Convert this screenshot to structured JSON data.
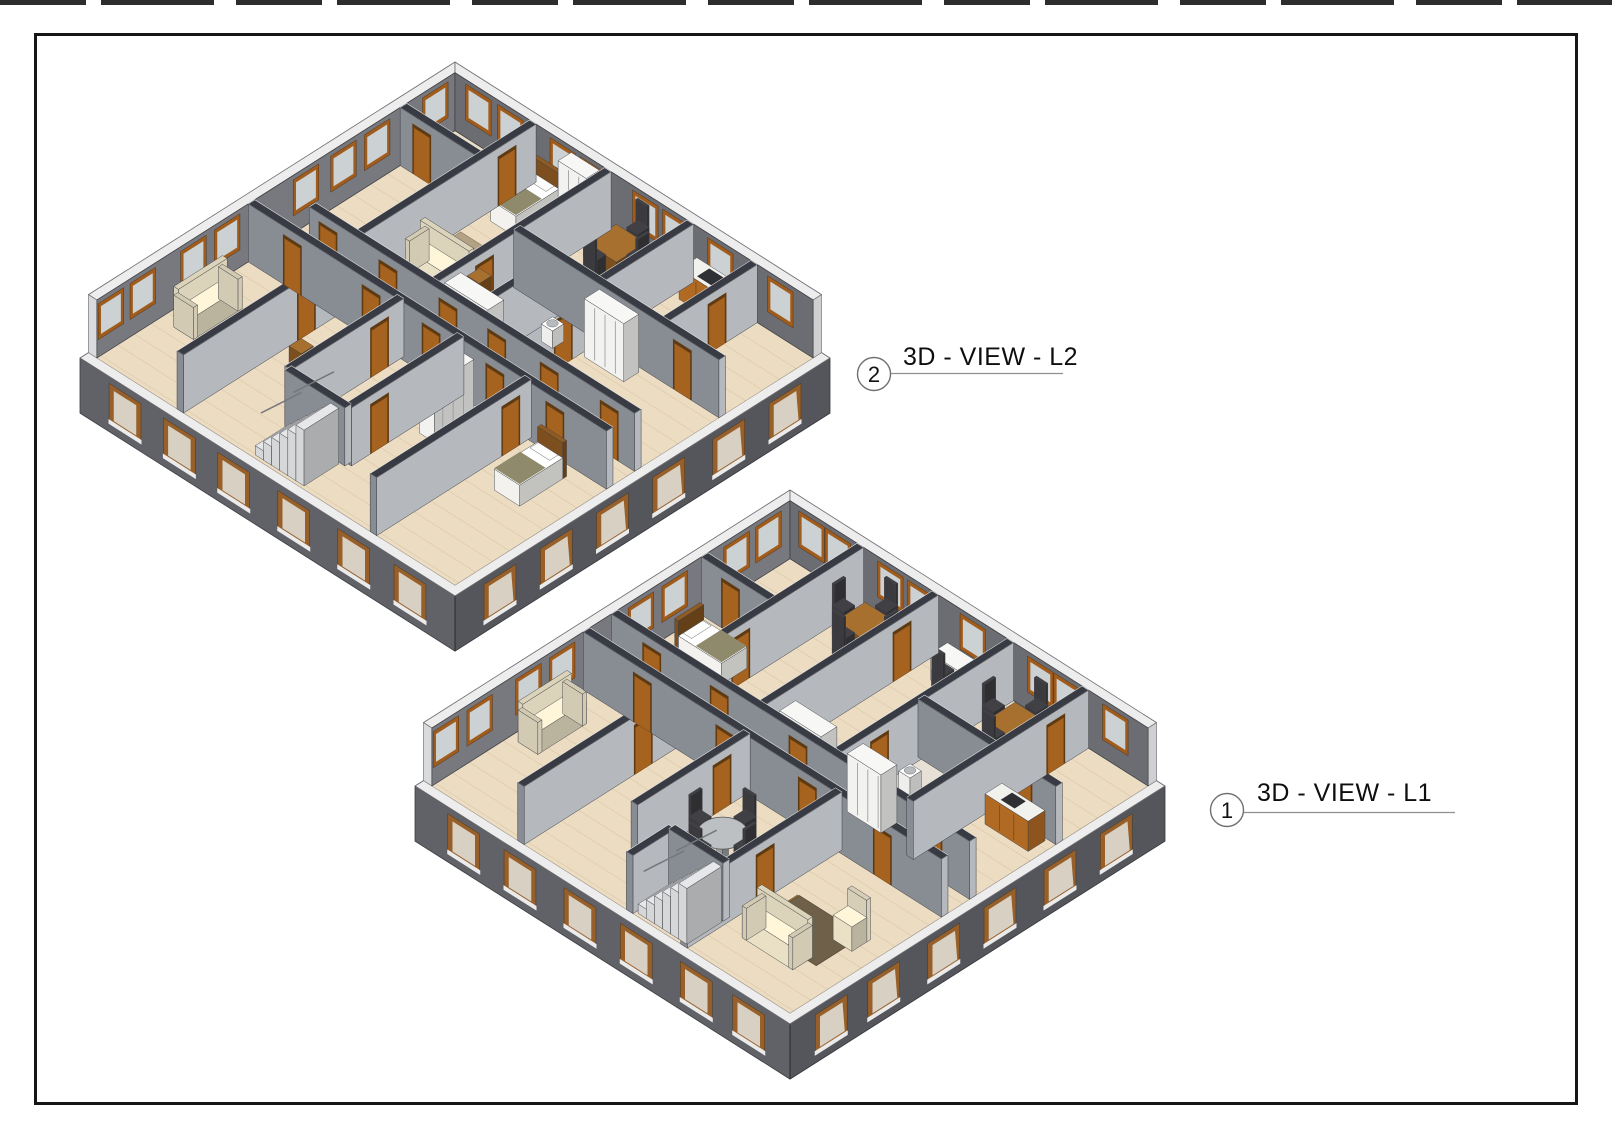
{
  "sheet": {
    "background": "#ffffff",
    "border_color": "#161616",
    "top_crop_marks": "cropped text row"
  },
  "palette": {
    "ext_sw": "#606267",
    "ext_se": "#54565b",
    "band": "#ededee",
    "floor": "#ecdcc2",
    "plank_line": "rgba(150,120,80,0.18)",
    "tile": "#e6e0d6",
    "far_left": "#77797e",
    "far_right": "#6b6d72",
    "face_l": "#b5b8bd",
    "face_m": "#888c93",
    "cap": "#383b43",
    "cap_edge": "#e8e8e8",
    "win_frame": "#a05c1d",
    "win_glass": "#ccd1d4",
    "near_win_frame": "#97602b",
    "near_win_glass": "#d8d1c3",
    "near_win_sill": "#ebebeb",
    "door": "#a6631f",
    "door_frame": "#5e3a12",
    "wood": "#7d4f1e",
    "wood_top": "#a8702f",
    "white": "#f3f2ef",
    "cream": "#e9e0c6",
    "chair": "#3b3b3f",
    "blanket": "#8f8a6b",
    "stair": "#d6d7d8",
    "railing": "#75777c",
    "outline": "#3f4146",
    "callout_line": "#8f8f8f",
    "callout_circle": "#707070"
  },
  "views": [
    {
      "id": "view-l2",
      "callout": {
        "number": "2",
        "title": "3D - VIEW - L2"
      },
      "building": {
        "origin": {
          "x": 455,
          "y": 120
        },
        "iso": {
          "A": 18.75,
          "B": 11.9,
          "H": 58
        },
        "plan": 20,
        "band": 0.45,
        "slab": 0.95,
        "walls": [
          {
            "o": "x",
            "c": 9.8,
            "a": 2.2,
            "b": 19.55,
            "doors": [
              3.2,
              6.4,
              9.6,
              12.2,
              15.0,
              18.2
            ]
          },
          {
            "o": "x",
            "c": 11.3,
            "a": 0.45,
            "b": 19.55,
            "doors": [
              2.8,
              7.0,
              10.2,
              13.6,
              16.8
            ]
          },
          {
            "o": "y",
            "c": 4.6,
            "a": 0.45,
            "b": 9.8,
            "doors": [
              2.0
            ]
          },
          {
            "o": "y",
            "c": 8.6,
            "a": 0.45,
            "b": 9.8,
            "doors": [
              7.2
            ]
          },
          {
            "o": "x",
            "c": 5.3,
            "a": 8.6,
            "b": 19.55,
            "doors": [
              14.2,
              17.6
            ]
          },
          {
            "o": "y",
            "c": 13.0,
            "a": 0.45,
            "b": 9.8,
            "doors": [
              7.4
            ]
          },
          {
            "o": "y",
            "c": 16.4,
            "a": 0.45,
            "b": 5.3,
            "doors": [
              2.6
            ]
          },
          {
            "o": "y",
            "c": 10.8,
            "a": 5.3,
            "b": 9.8,
            "doors": []
          },
          {
            "o": "x",
            "c": 3.2,
            "a": 0.45,
            "b": 4.6,
            "doors": [
              1.6
            ]
          },
          {
            "o": "y",
            "c": 4.9,
            "a": 11.3,
            "b": 19.55,
            "doors": [
              13.0
            ]
          },
          {
            "o": "y",
            "c": 8.4,
            "a": 11.3,
            "b": 17.3,
            "doors": [
              12.6
            ]
          },
          {
            "o": "y",
            "c": 11.6,
            "a": 11.3,
            "b": 17.3,
            "doors": [
              15.8
            ]
          },
          {
            "o": "x",
            "c": 17.3,
            "a": 8.4,
            "b": 11.6,
            "doors": []
          },
          {
            "o": "y",
            "c": 15.2,
            "a": 11.3,
            "b": 19.55,
            "doors": [
              12.4
            ]
          }
        ],
        "far_windows": {
          "left": [
            1.5,
            4.6,
            6.4,
            8.4,
            12.6,
            14.4,
            17.1,
            18.8
          ],
          "right": [
            1.7,
            3.4,
            6.2,
            7.8,
            10.6,
            12.2,
            14.6,
            17.8
          ]
        },
        "near_windows": {
          "sw": [
            2.4,
            5.3,
            8.2,
            11.4,
            14.6,
            17.6
          ],
          "se": [
            2.4,
            5.4,
            8.6,
            11.6,
            14.6,
            17.6
          ]
        },
        "floor_patches": [
          {
            "x": 8.8,
            "y": 5.5,
            "w": 4.0,
            "d": 4.1,
            "c": "#e6e0d6"
          }
        ],
        "furniture": [
          {
            "t": "bed",
            "x": 5.2,
            "y": 0.8,
            "w": 1.35,
            "d": 2.5,
            "dir": "y"
          },
          {
            "t": "wardrobe",
            "x": 6.9,
            "y": 0.7,
            "w": 1.5,
            "d": 0.7
          },
          {
            "t": "rug",
            "x": 4.9,
            "y": 4.6,
            "w": 2.9,
            "d": 2.1,
            "c": "#b3a183"
          },
          {
            "t": "sofa",
            "x": 5.0,
            "y": 6.6,
            "w": 2.6,
            "d": 1.05,
            "dir": "x"
          },
          {
            "t": "sidetable",
            "x": 7.9,
            "y": 6.6
          },
          {
            "t": "table4",
            "x": 10.6,
            "y": 2.0
          },
          {
            "t": "counter",
            "x": 13.5,
            "y": 0.6,
            "w": 2.7,
            "d": 0.95
          },
          {
            "t": "wardrobe",
            "x": 9.0,
            "y": 8.7,
            "w": 2.3,
            "d": 0.85
          },
          {
            "t": "wardrobe",
            "x": 13.4,
            "y": 5.7,
            "w": 2.1,
            "d": 0.8
          },
          {
            "t": "sink",
            "x": 9.3,
            "y": 6.2
          },
          {
            "t": "sink",
            "x": 11.6,
            "y": 6.4
          },
          {
            "t": "bed",
            "x": 16.6,
            "y": 12.0,
            "w": 1.35,
            "d": 2.5,
            "dir": "y"
          },
          {
            "t": "sofa",
            "x": 1.2,
            "y": 13.6,
            "w": 1.05,
            "d": 2.6,
            "dir": "y"
          },
          {
            "t": "wardrobe",
            "x": 12.2,
            "y": 12.0,
            "w": 0.8,
            "d": 2.1,
            "dir": "y"
          },
          {
            "t": "sidetable",
            "x": 6.1,
            "y": 14.3
          }
        ],
        "stairs": {
          "x": 8.75,
          "y": 17.55,
          "len": 2.6,
          "wid": 1.85
        }
      }
    },
    {
      "id": "view-l1",
      "callout": {
        "number": "1",
        "title": "3D - VIEW - L1"
      },
      "building": {
        "origin": {
          "x": 790,
          "y": 548
        },
        "iso": {
          "A": 18.75,
          "B": 11.9,
          "H": 58
        },
        "plan": 20,
        "band": 0.45,
        "slab": 0.95,
        "walls": [
          {
            "o": "x",
            "c": 9.8,
            "a": 0.45,
            "b": 19.55,
            "doors": [
              2.6,
              6.2,
              10.4,
              14.0,
              17.6
            ]
          },
          {
            "o": "x",
            "c": 11.3,
            "a": 0.45,
            "b": 19.55,
            "doors": [
              3.6,
              8.0,
              12.4,
              16.4
            ]
          },
          {
            "o": "y",
            "c": 4.2,
            "a": 0.45,
            "b": 9.8,
            "doors": [
              7.0
            ]
          },
          {
            "o": "y",
            "c": 8.2,
            "a": 0.45,
            "b": 9.8,
            "doors": [
              2.4
            ]
          },
          {
            "o": "y",
            "c": 12.2,
            "a": 0.45,
            "b": 9.8,
            "doors": [
              7.6
            ]
          },
          {
            "o": "y",
            "c": 16.2,
            "a": 0.45,
            "b": 9.8,
            "doors": [
              2.2
            ]
          },
          {
            "o": "x",
            "c": 5.2,
            "a": 12.2,
            "b": 19.55,
            "doors": [
              17.8
            ]
          },
          {
            "o": "x",
            "c": 5.0,
            "a": 0.45,
            "b": 4.2,
            "doors": [
              2.0
            ]
          },
          {
            "o": "y",
            "c": 5.2,
            "a": 11.3,
            "b": 19.55,
            "doors": [
              13.2
            ]
          },
          {
            "o": "y",
            "c": 9.0,
            "a": 11.3,
            "b": 17.3,
            "doors": [
              12.8
            ]
          },
          {
            "o": "y",
            "c": 13.9,
            "a": 11.3,
            "b": 19.55,
            "doors": [
              15.4
            ]
          },
          {
            "o": "x",
            "c": 17.3,
            "a": 11.0,
            "b": 13.9,
            "doors": []
          },
          {
            "o": "y",
            "c": 11.0,
            "a": 17.3,
            "b": 19.55,
            "doors": []
          }
        ],
        "far_windows": {
          "left": [
            1.6,
            3.3,
            6.6,
            8.4,
            12.6,
            14.4,
            17.0,
            18.8
          ],
          "right": [
            1.6,
            3.0,
            5.8,
            7.4,
            10.2,
            13.8,
            15.2,
            17.8
          ]
        },
        "near_windows": {
          "sw": [
            2.6,
            5.6,
            8.8,
            11.8,
            15.0,
            17.8
          ],
          "se": [
            2.6,
            5.6,
            8.8,
            11.8,
            15.0,
            17.8
          ]
        },
        "floor_patches": [
          {
            "x": 12.4,
            "y": 5.4,
            "w": 3.6,
            "d": 4.2,
            "c": "#e6e0d6"
          }
        ],
        "furniture": [
          {
            "t": "table4",
            "x": 6.2,
            "y": 2.2
          },
          {
            "t": "table4",
            "x": 14.4,
            "y": 2.4
          },
          {
            "t": "desk",
            "x": 9.3,
            "y": 0.9,
            "w": 2.2,
            "d": 0.9
          },
          {
            "t": "bed",
            "x": 1.4,
            "y": 6.2,
            "w": 2.5,
            "d": 1.35,
            "dir": "x"
          },
          {
            "t": "wardrobe",
            "x": 9.0,
            "y": 8.7,
            "w": 2.2,
            "d": 0.85
          },
          {
            "t": "wardrobe",
            "x": 12.6,
            "y": 8.7,
            "w": 1.8,
            "d": 0.85
          },
          {
            "t": "counter",
            "x": 16.8,
            "y": 5.5,
            "w": 2.3,
            "d": 0.9
          },
          {
            "t": "sink",
            "x": 13.0,
            "y": 6.6
          },
          {
            "t": "sofa",
            "x": 0.9,
            "y": 12.8,
            "w": 1.05,
            "d": 2.6,
            "dir": "y"
          },
          {
            "t": "round_table",
            "x": 11.3,
            "y": 14.9
          },
          {
            "t": "rug",
            "x": 14.9,
            "y": 14.4,
            "w": 3.4,
            "d": 2.5,
            "c": "#6e6049"
          },
          {
            "t": "armchair",
            "x": 17.6,
            "y": 14.3
          },
          {
            "t": "sidetable",
            "x": 15.8,
            "y": 15.4
          },
          {
            "t": "sofa",
            "x": 15.1,
            "y": 16.6,
            "w": 2.7,
            "d": 1.05,
            "dir": "x"
          }
        ],
        "stairs": {
          "x": 11.3,
          "y": 17.55,
          "len": 2.6,
          "wid": 1.85
        }
      }
    }
  ]
}
